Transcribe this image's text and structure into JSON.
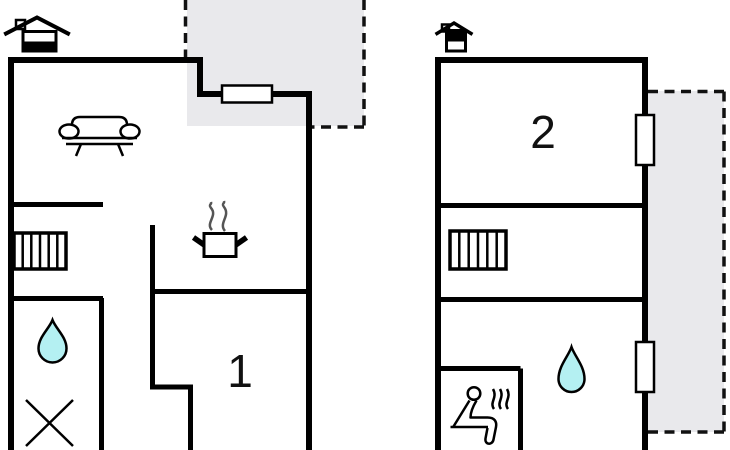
{
  "colors": {
    "wall": "#000000",
    "outdoor_fill": "#e9e9ec",
    "water_fill": "#b4f0f2",
    "steam_gray": "#555555"
  },
  "left_plan": {
    "room_label": "1",
    "level_icon": "house-lower-level-icon",
    "icons": [
      "sofa-icon",
      "radiator-icon",
      "water-drop-icon",
      "cross-icon",
      "cooking-pot-icon"
    ],
    "outdoor_area": "terrace-dashed-area",
    "windows": 1
  },
  "right_plan": {
    "room_label": "2",
    "level_icon": "house-upper-level-icon",
    "icons": [
      "radiator-icon",
      "water-drop-icon",
      "sauna-icon"
    ],
    "outdoor_area": "balcony-dashed-area",
    "windows": 2
  }
}
